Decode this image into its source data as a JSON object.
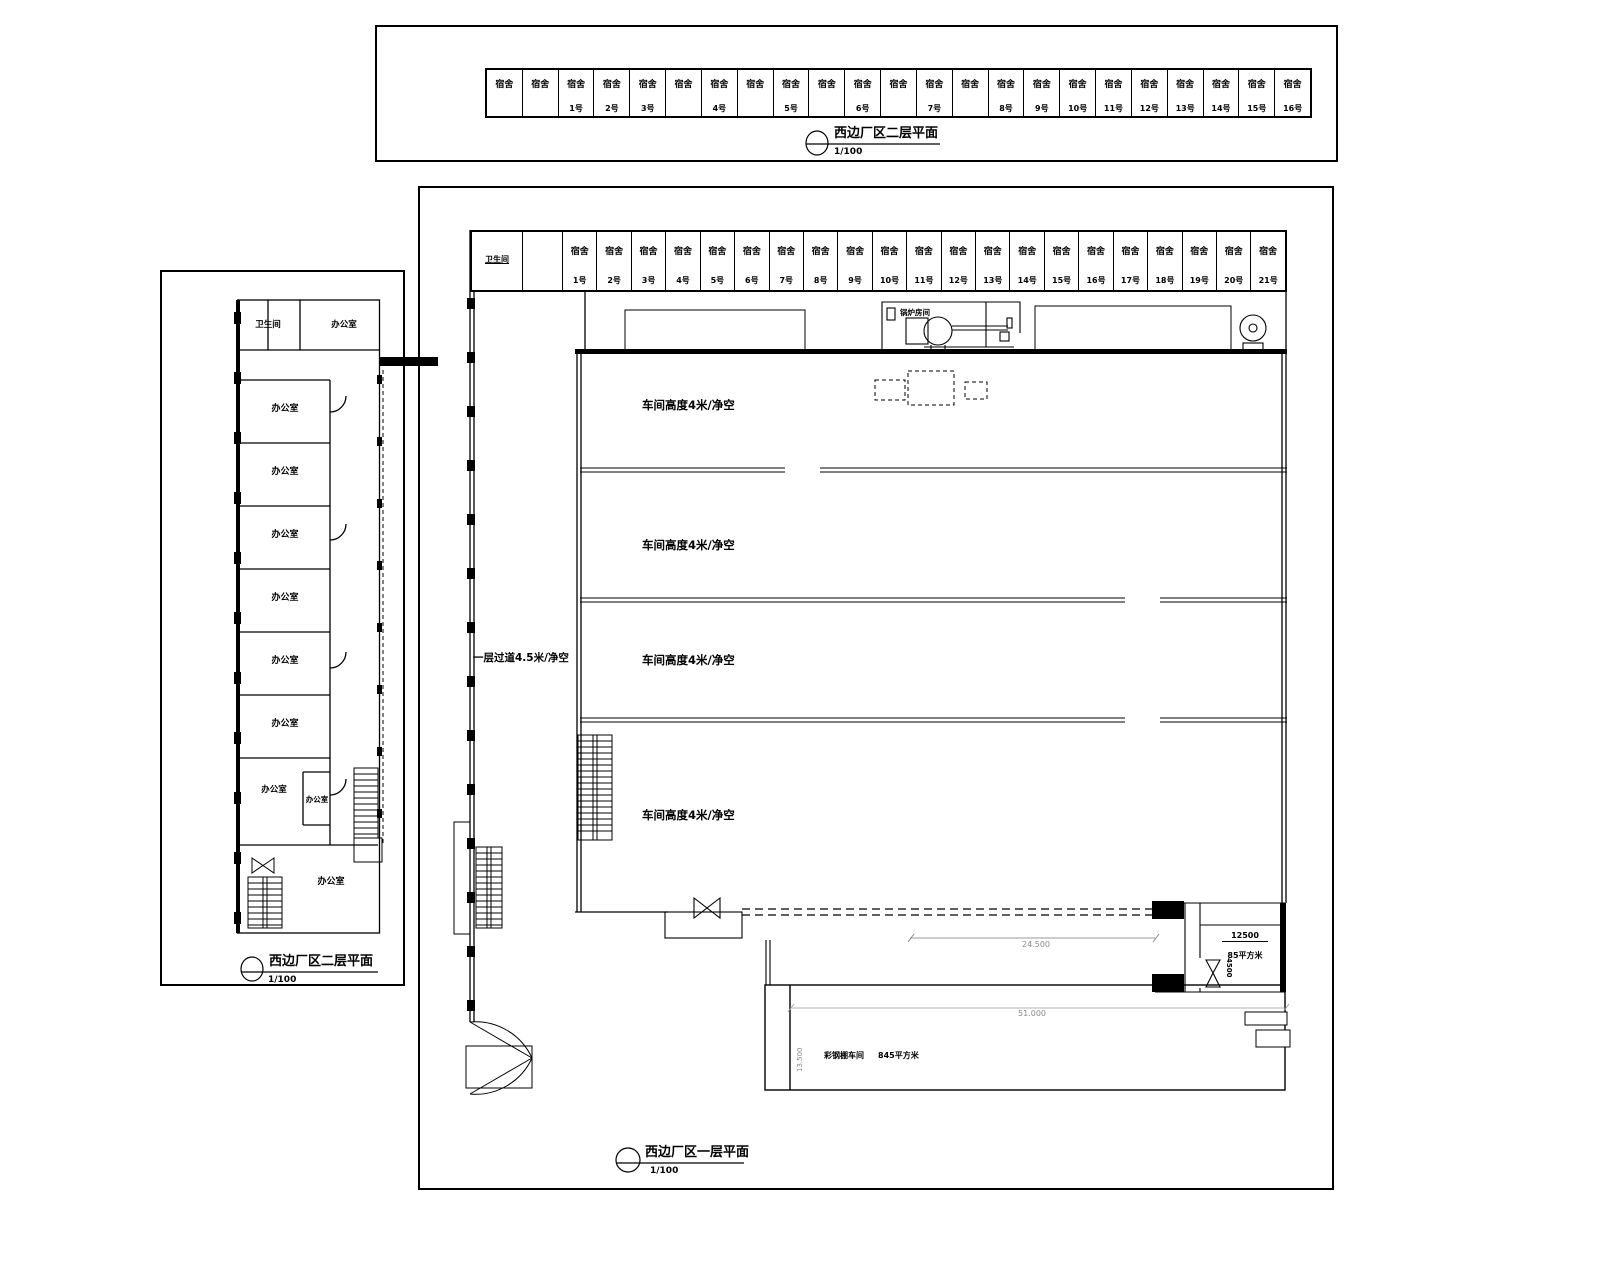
{
  "colors": {
    "line": "#000000",
    "bg": "#ffffff",
    "faint": "#9a9a9a"
  },
  "strip_2f": {
    "title": "西边厂区二层平面",
    "scale": "1/100",
    "cells": [
      {
        "l": "宿舍",
        "n": ""
      },
      {
        "l": "宿舍",
        "n": ""
      },
      {
        "l": "宿舍",
        "n": "1号"
      },
      {
        "l": "宿舍",
        "n": "2号"
      },
      {
        "l": "宿舍",
        "n": "3号"
      },
      {
        "l": "宿舍",
        "n": ""
      },
      {
        "l": "宿舍",
        "n": "4号"
      },
      {
        "l": "宿舍",
        "n": ""
      },
      {
        "l": "宿舍",
        "n": "5号"
      },
      {
        "l": "宿舍",
        "n": ""
      },
      {
        "l": "宿舍",
        "n": "6号"
      },
      {
        "l": "宿舍",
        "n": ""
      },
      {
        "l": "宿舍",
        "n": "7号"
      },
      {
        "l": "宿舍",
        "n": ""
      },
      {
        "l": "宿舍",
        "n": "8号"
      },
      {
        "l": "宿舍",
        "n": "9号"
      },
      {
        "l": "宿舍",
        "n": "10号"
      },
      {
        "l": "宿舍",
        "n": "11号"
      },
      {
        "l": "宿舍",
        "n": "12号"
      },
      {
        "l": "宿舍",
        "n": "13号"
      },
      {
        "l": "宿舍",
        "n": "14号"
      },
      {
        "l": "宿舍",
        "n": "15号"
      },
      {
        "l": "宿舍",
        "n": "16号"
      }
    ]
  },
  "left_2f": {
    "title": "西边厂区二层平面",
    "scale": "1/100",
    "toilet": "卫生间",
    "office_top": "办公室",
    "offices": [
      {
        "l": "办公室"
      },
      {
        "l": "办公室"
      },
      {
        "l": "办公室"
      },
      {
        "l": "办公室"
      },
      {
        "l": "办公室"
      },
      {
        "l": "办公室"
      }
    ],
    "office_mid": "办公室",
    "office_small": "办公室",
    "office_bottom": "办公室"
  },
  "main_1f": {
    "title": "西边厂区一层平面",
    "scale": "1/100",
    "toilet": "卫生间",
    "dorm_cells": [
      {
        "l": "宿舍",
        "n": "1号"
      },
      {
        "l": "宿舍",
        "n": "2号"
      },
      {
        "l": "宿舍",
        "n": "3号"
      },
      {
        "l": "宿舍",
        "n": "4号"
      },
      {
        "l": "宿舍",
        "n": "5号"
      },
      {
        "l": "宿舍",
        "n": "6号"
      },
      {
        "l": "宿舍",
        "n": "7号"
      },
      {
        "l": "宿舍",
        "n": "8号"
      },
      {
        "l": "宿舍",
        "n": "9号"
      },
      {
        "l": "宿舍",
        "n": "10号"
      },
      {
        "l": "宿舍",
        "n": "11号"
      },
      {
        "l": "宿舍",
        "n": "12号"
      },
      {
        "l": "宿舍",
        "n": "13号"
      },
      {
        "l": "宿舍",
        "n": "14号"
      },
      {
        "l": "宿舍",
        "n": "15号"
      },
      {
        "l": "宿舍",
        "n": "16号"
      },
      {
        "l": "宿舍",
        "n": "17号"
      },
      {
        "l": "宿舍",
        "n": "18号"
      },
      {
        "l": "宿舍",
        "n": "19号"
      },
      {
        "l": "宿舍",
        "n": "20号"
      },
      {
        "l": "宿舍",
        "n": "21号"
      }
    ],
    "corridor_label": "一层过道4.5米/净空",
    "workshop_labels": [
      {
        "l": "车间高度4米/净空"
      },
      {
        "l": "车间高度4米/净空"
      },
      {
        "l": "车间高度4米/净空"
      },
      {
        "l": "车间高度4米/净空"
      }
    ],
    "boiler_label": "锅炉房间",
    "annex": {
      "dim_top": "12500",
      "area": "85平方米",
      "dim_side": "4500"
    },
    "dims": {
      "wall": "24.500",
      "yard_width": "51.000",
      "yard_height": "13.500"
    },
    "shed": {
      "name": "彩钢棚车间",
      "area": "845平方米"
    }
  }
}
